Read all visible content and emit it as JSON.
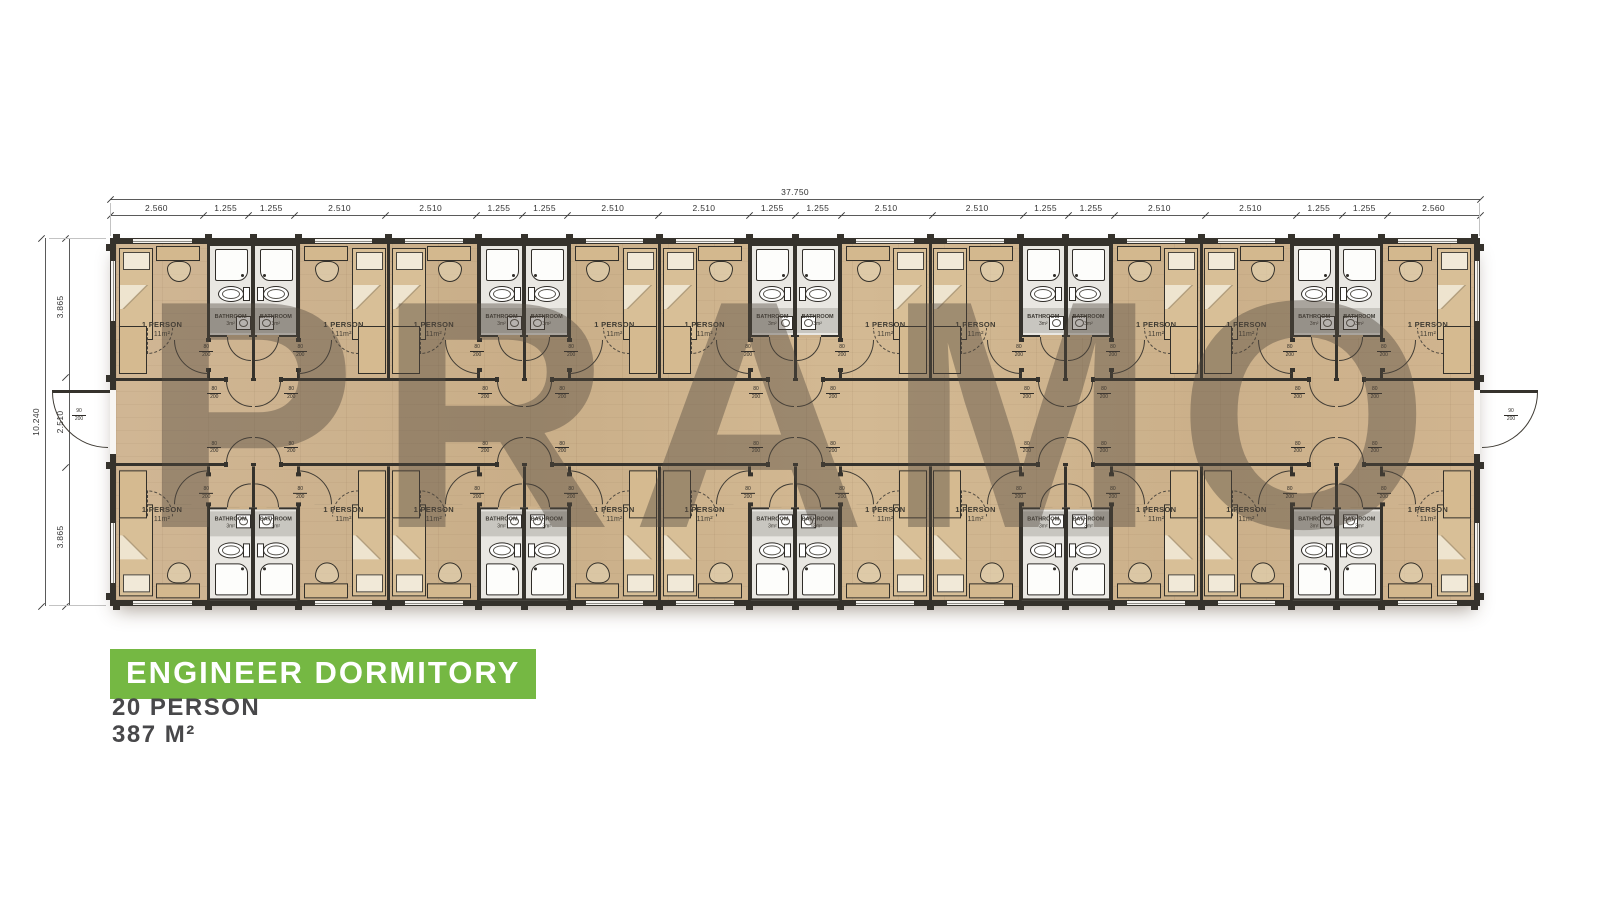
{
  "watermark": "PRAMO",
  "title": {
    "banner": "ENGINEER DORMITORY",
    "capacity": "20 PERSON",
    "area": "387 M²"
  },
  "dimensions": {
    "total_width": "37.750",
    "total_height": "10.240",
    "top_segments": [
      "2.560",
      "1.255",
      "1.255",
      "2.510",
      "2.510",
      "1.255",
      "1.255",
      "2.510",
      "2.510",
      "1.255",
      "1.255",
      "2.510",
      "2.510",
      "1.255",
      "1.255",
      "2.510",
      "2.510",
      "1.255",
      "1.255",
      "2.560"
    ],
    "left_segments": [
      "3.865",
      "2.510",
      "3.865"
    ]
  },
  "rooms": {
    "label": "1 PERSON",
    "area": "11m²"
  },
  "bathrooms": {
    "label": "BATHROOM",
    "area": "3m²"
  },
  "doors": {
    "interior": {
      "width": "80",
      "height": "200"
    },
    "exterior": {
      "width": "90",
      "height": "200"
    }
  },
  "colors": {
    "accent_green": "#75b843",
    "wall": "#35322c",
    "wood_floor": "#cdb28c",
    "bathroom_floor": "#e9e7e2",
    "watermark": "rgba(82,72,62,0.42)"
  }
}
